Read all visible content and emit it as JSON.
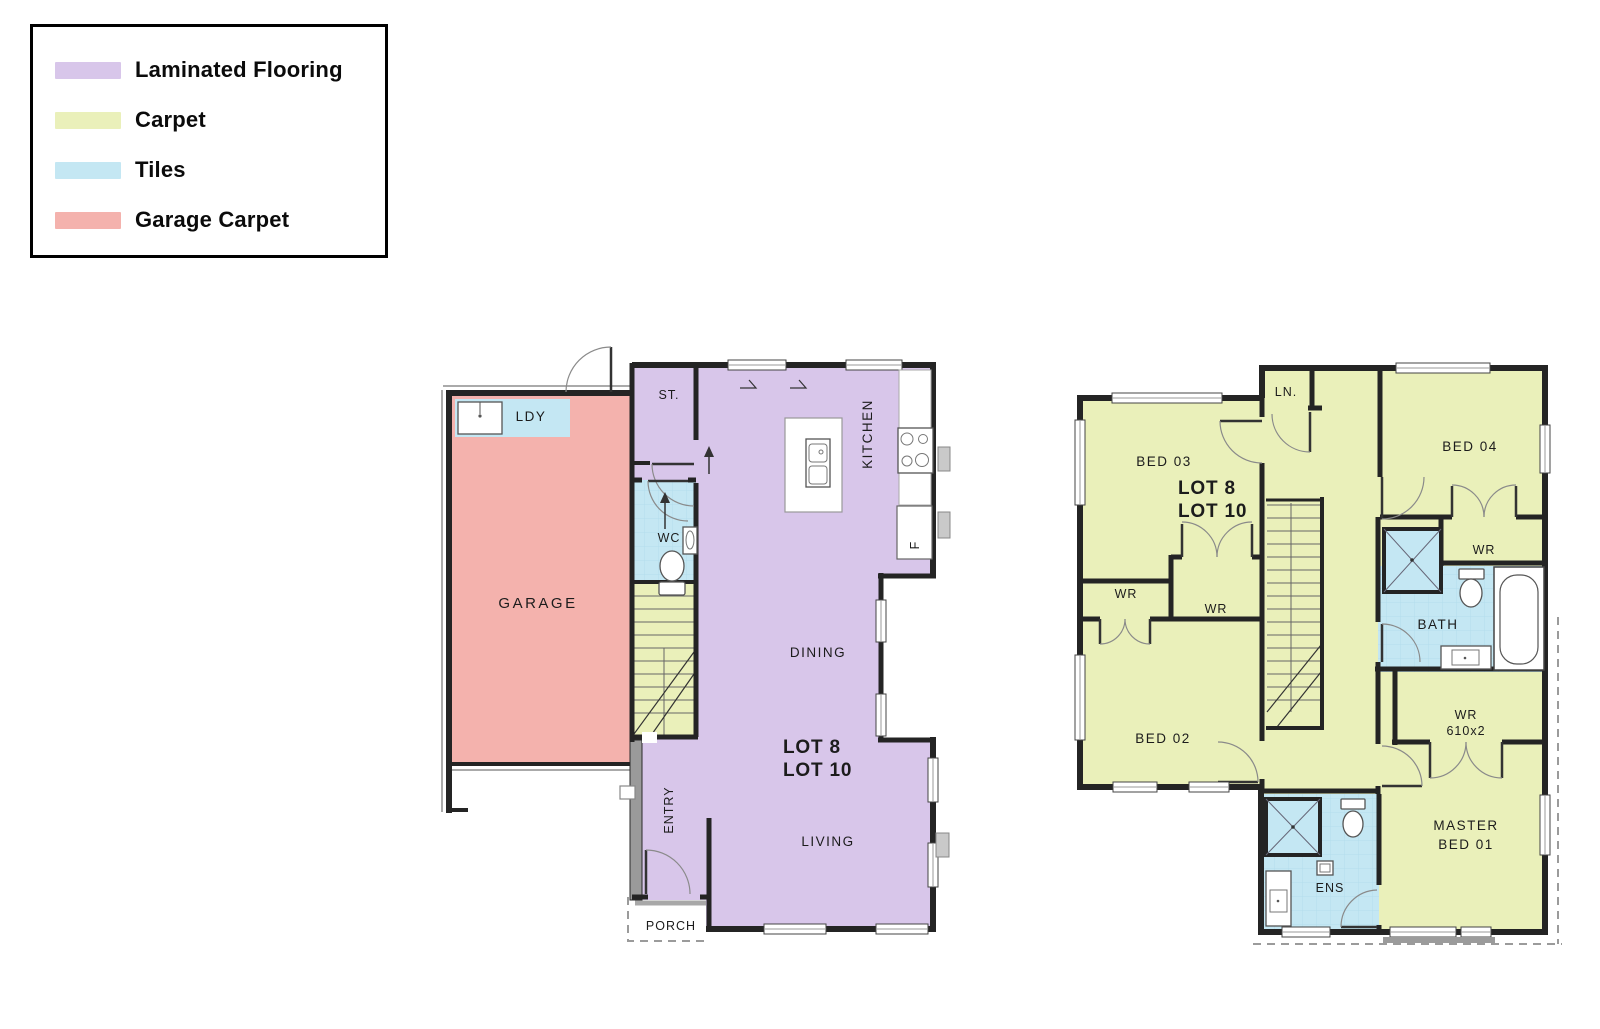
{
  "colors": {
    "laminated_flooring": "#d8c6ea",
    "carpet": "#eaf0ba",
    "tiles": "#c4e7f3",
    "garage_carpet": "#f4b2ad",
    "wall": "#242424",
    "background": "#ffffff"
  },
  "legend": {
    "items": [
      {
        "key": "laminated_flooring",
        "label": "Laminated Flooring"
      },
      {
        "key": "carpet",
        "label": "Carpet"
      },
      {
        "key": "tiles",
        "label": "Tiles"
      },
      {
        "key": "garage_carpet",
        "label": "Garage Carpet"
      }
    ]
  },
  "ground_floor": {
    "lot_line1": "LOT 8",
    "lot_line2": "LOT 10",
    "rooms": {
      "garage": "GARAGE",
      "laundry": "LDY",
      "storage": "ST.",
      "wc": "WC",
      "kitchen": "KITCHEN",
      "fridge": "F",
      "dining": "DINING",
      "living": "LIVING",
      "entry": "ENTRY",
      "porch": "PORCH"
    }
  },
  "upper_floor": {
    "lot_line1": "LOT 8",
    "lot_line2": "LOT 10",
    "rooms": {
      "linen": "LN.",
      "bed03": "BED 03",
      "bed04": "BED 04",
      "bed02": "BED 02",
      "master_line1": "MASTER",
      "master_line2": "BED 01",
      "wr_bed02": "WR",
      "wr_bed03": "WR",
      "wr_bed04": "WR",
      "wr_master_line1": "WR",
      "wr_master_line2": "610x2",
      "bath": "BATH",
      "ensuite": "ENS"
    }
  }
}
